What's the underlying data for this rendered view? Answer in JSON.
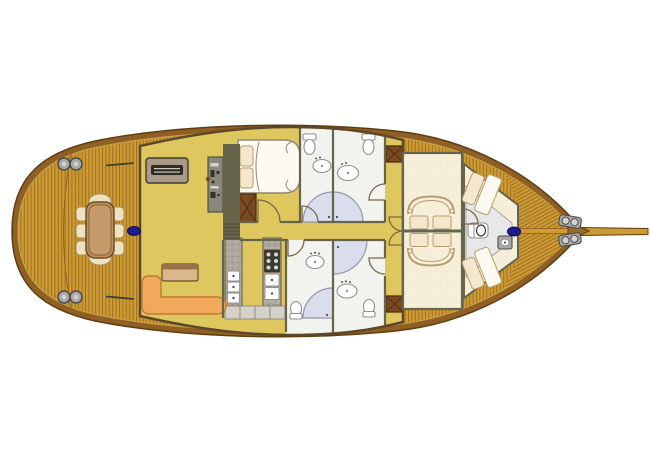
{
  "figure": {
    "label": "sailing-yacht-deck-plan",
    "canvas_width": 650,
    "canvas_height": 459
  },
  "palette": {
    "bg": "#ffffff",
    "deck": "#CE9A33",
    "deckline": "#9C7120",
    "deckseam": "#8A6820",
    "caprail": "#8F5F24",
    "hulledge": "#5F3D12",
    "caprailinner": "#C9A04A",
    "salon": "#DFC75F",
    "cabinfloor": "#F7EFDA",
    "cabindot": "#EADFC2",
    "bathfloor": "#F5F5F1",
    "bathdot": "#D9D9D4",
    "crewfloor": "#E9E9EB",
    "crewdot": "#D6D6DA",
    "shower": "#D9DDEC",
    "showeredge": "#9398A8",
    "wallolive": "#67644C",
    "wallbrown": "#5E482A",
    "wood": "#7B4A21",
    "woodx": "#4E2D10",
    "porcelain": "#FFFFFF",
    "fixtureedge": "#90908C",
    "pillow": "#F5E7CB",
    "pillowedge": "#B79C6F",
    "bedwhite": "#FDFAF1",
    "bededge": "#8E8877",
    "sofa": "#F2A95C",
    "sofaedge": "#BE7B2F",
    "counter": "#ACA89E",
    "counterspeck1": "#C2BEB4",
    "counterspeck2": "#8F8B81",
    "counteredge": "#6E6A5E",
    "tile": "#D5D1C9",
    "tileedge": "#8A867C",
    "stove": "#3B3A35",
    "stoveknob": "#D8D8D3",
    "appliance": "#FBFBF9",
    "appliancedot": "#3A3A36",
    "mast": "#1D1D92",
    "mastedge": "#0D0D4E",
    "metal": "#A9A9A7",
    "metaldark": "#4B4B49",
    "metallight": "#D2D2D0",
    "tabletan": "#BA9160",
    "tableinner": "#C49A68",
    "tableedge": "#6F4C26",
    "chair": "#EFE2C0",
    "chairedge": "#A9905F",
    "console": "#8A887B",
    "consoleedge": "#54513F",
    "consolemark": "#D8D5C8",
    "consoledark": "#35322A",
    "sideboard": "#A89A87",
    "sideboardedge": "#3F3A30",
    "slot": "#2F2B25",
    "slotline": "#CFCABD",
    "coffee": "#D9B98C",
    "coffeetop": "#9A7448",
    "door": "#7A6A45",
    "steps": "#4E4B3A",
    "gate": "#3F3F33",
    "bowtip": "#9A6B28"
  },
  "plan": {
    "areas": [
      {
        "name": "aft-deck",
        "items": [
          "dining-table",
          "dining-chairs-x6",
          "bench-seats-x2",
          "winches-x4",
          "aft-mast",
          "boarding-gates-x2"
        ]
      },
      {
        "name": "salon",
        "items": [
          "sideboard",
          "nav-console",
          "companionway-steps",
          "l-shaped-sofa",
          "cabinet"
        ]
      },
      {
        "name": "midship-cabin",
        "items": [
          "double-bed",
          "pillows-x2",
          "wardrobe"
        ]
      },
      {
        "name": "bathrooms",
        "items": [
          "toilets-x4",
          "sinks-x4",
          "showers-x4"
        ]
      },
      {
        "name": "galley",
        "items": [
          "stove",
          "counters-x2",
          "drawer-units-x5",
          "base-cabinets-x4"
        ]
      },
      {
        "name": "corridor",
        "items": [
          "double-entry-doors",
          "wardrobes-x2"
        ]
      },
      {
        "name": "fore-cabins",
        "items": [
          "double-beds-x2",
          "pillows-x4",
          "curved-footboards-x2"
        ]
      },
      {
        "name": "crew-quarters",
        "items": [
          "berths-x2",
          "toilet",
          "sink",
          "fore-mast"
        ]
      },
      {
        "name": "bow-deck",
        "items": [
          "windlass-x2",
          "bowsprit",
          "centerline-plank"
        ]
      }
    ]
  }
}
